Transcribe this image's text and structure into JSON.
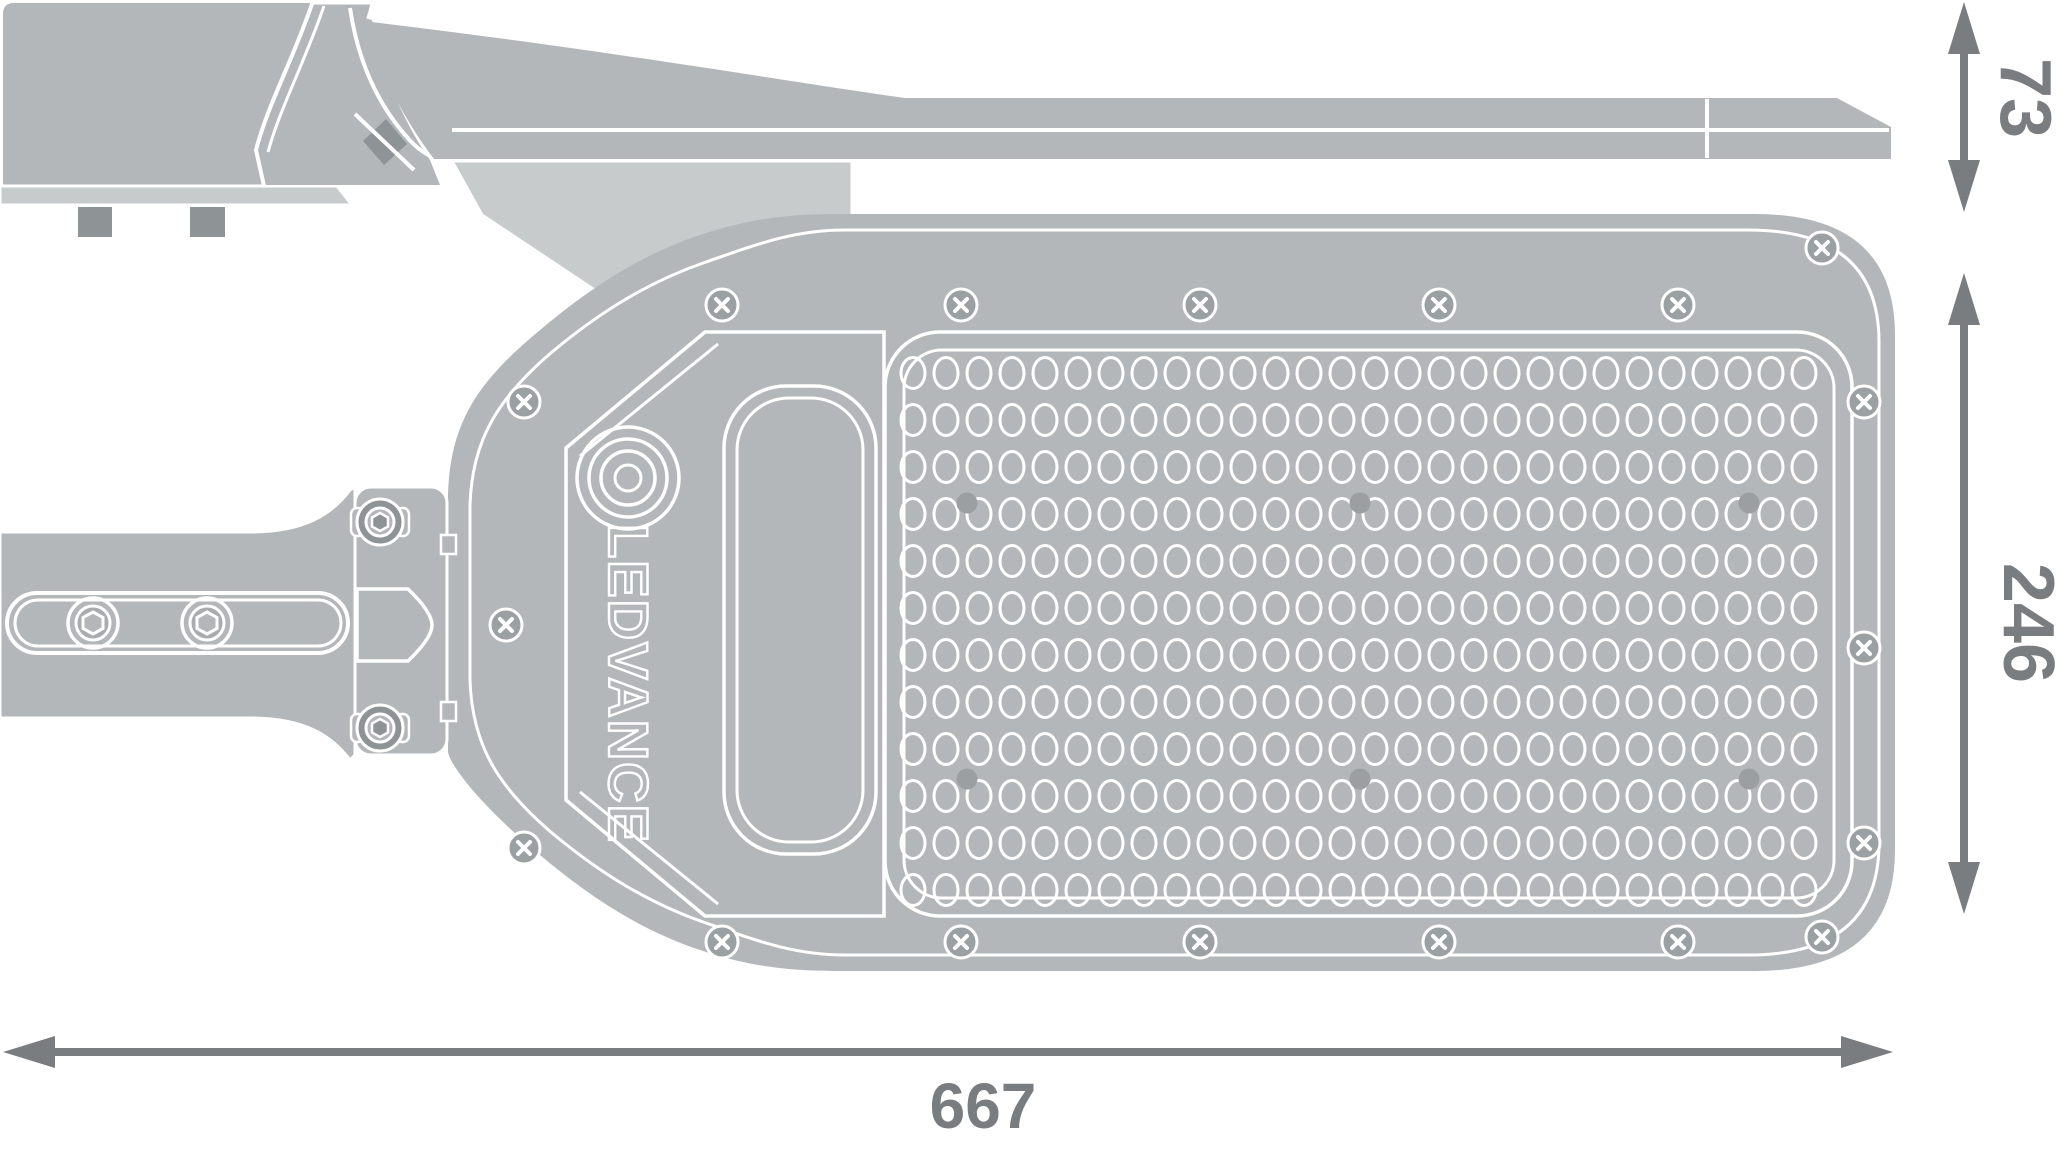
{
  "drawing": {
    "brand_logo": "LEDVANCE",
    "dimensions": {
      "side_height": {
        "value": "73"
      },
      "plan_height": {
        "value": "246"
      },
      "total_length": {
        "value": "667"
      }
    },
    "led_array": {
      "rows": 12,
      "cols": 28,
      "screw_dots": 6
    },
    "perimeter_screws": {
      "count": 18
    },
    "arm_bolts": {
      "count": 2
    },
    "clamp_bolts": {
      "count": 2
    },
    "colors": {
      "body_gray": "#b4b7b9",
      "light_gray": "#c8cbcc",
      "dark_gray": "#8e9395",
      "line_white": "#ffffff",
      "dimension_gray": "#797d80"
    }
  }
}
